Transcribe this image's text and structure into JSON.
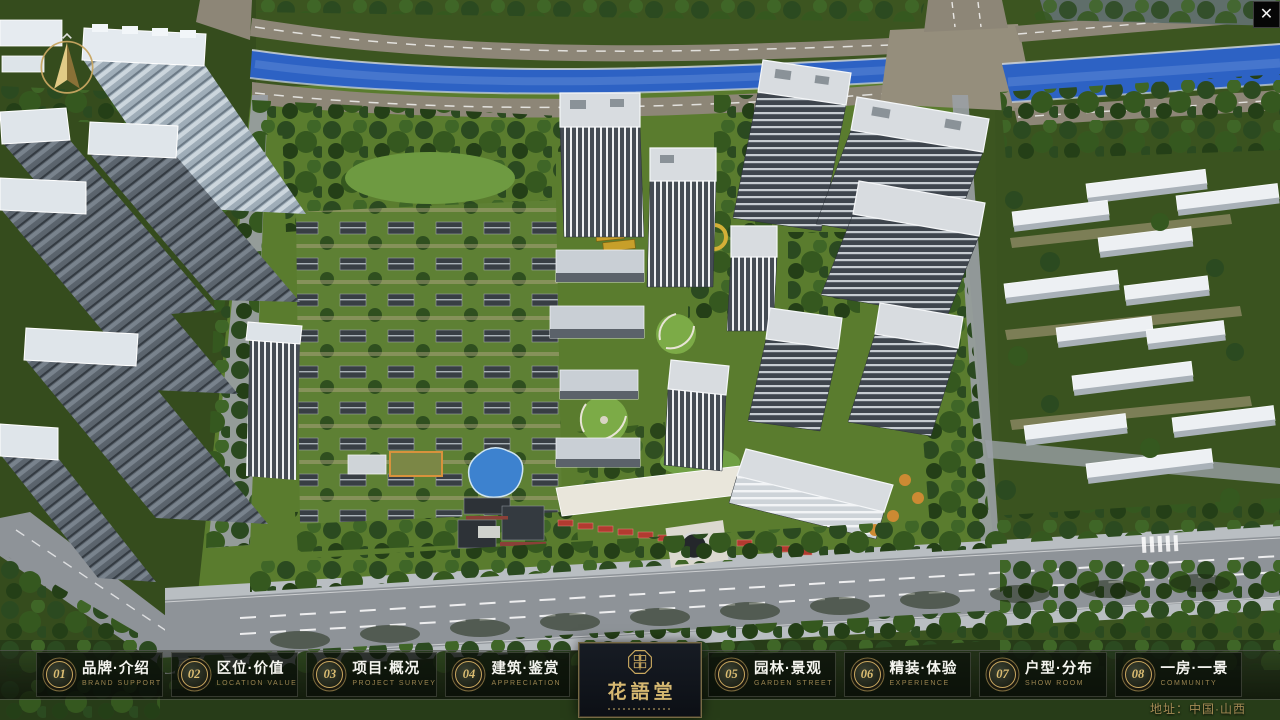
{
  "nav": {
    "items": [
      {
        "num": "01",
        "label": "品牌·介绍",
        "sublabel": "BRAND SUPPORT"
      },
      {
        "num": "02",
        "label": "区位·价值",
        "sublabel": "LOCATION VALUE"
      },
      {
        "num": "03",
        "label": "项目·概况",
        "sublabel": "PROJECT SURVEY"
      },
      {
        "num": "04",
        "label": "建筑·鉴赏",
        "sublabel": "APPRECIATION"
      },
      {
        "num": "05",
        "label": "园林·景观",
        "sublabel": "GARDEN STREET"
      },
      {
        "num": "06",
        "label": "精装·体验",
        "sublabel": "EXPERIENCE"
      },
      {
        "num": "07",
        "label": "户型·分布",
        "sublabel": "SHOW ROOM"
      },
      {
        "num": "08",
        "label": "一房·一景",
        "sublabel": "COMMUNITY"
      }
    ]
  },
  "logo": {
    "title": "花語堂"
  },
  "address": {
    "label": "地址：中国·山西"
  },
  "icons": {
    "close": "✕",
    "compass": "compass-north-arrow",
    "seal": "hua-yu-tang-seal"
  },
  "palette": {
    "gold": "#C9A85F",
    "nav_panel": "rgba(8,12,7,0.66)",
    "logo_bg": "#11151B",
    "river_blue": "#2D62C4",
    "road_gray": "#8E9398",
    "community_green": "#5A7C2E",
    "outskirt_green": "#35511F"
  }
}
